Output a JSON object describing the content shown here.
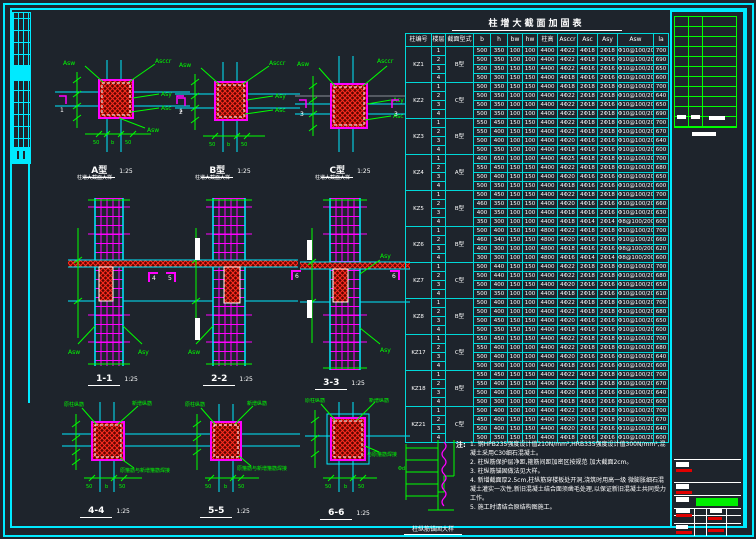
{
  "colors": {
    "frame": "#00eaff",
    "dims": "#00ff00",
    "rebar": "#ff00ff",
    "hatch": "#ff2d20",
    "text": "#ffffff"
  },
  "table": {
    "title": "柱增大截面加固表",
    "headers": [
      "柱编号",
      "楼层",
      "截面型式",
      "b",
      "h",
      "bw",
      "hw",
      "柱高",
      "Asccr",
      "Asc",
      "Asy",
      "Asw",
      "la"
    ],
    "groups": [
      {
        "id": "KZ1",
        "type": "B型",
        "rows": [
          [
            "1",
            "500",
            "350",
            "100",
            "100",
            "4400",
            "4Φ22",
            "4Φ18",
            "2Φ18",
            "Φ10@100/200",
            "700"
          ],
          [
            "2",
            "500",
            "350",
            "100",
            "100",
            "4400",
            "4Φ22",
            "4Φ18",
            "2Φ16",
            "Φ10@100/200",
            "690"
          ],
          [
            "3",
            "500",
            "350",
            "150",
            "150",
            "4400",
            "4Φ22",
            "4Φ16",
            "2Φ16",
            "Φ10@100/200",
            "650"
          ],
          [
            "4",
            "500",
            "300",
            "150",
            "150",
            "4400",
            "4Φ18",
            "4Φ16",
            "2Φ16",
            "Φ10@100/200",
            "600"
          ]
        ]
      },
      {
        "id": "KZ2",
        "type": "C型",
        "rows": [
          [
            "1",
            "500",
            "350",
            "150",
            "150",
            "4400",
            "4Φ18",
            "2Φ18",
            "2Φ18",
            "Φ10@100/200",
            "700"
          ],
          [
            "2",
            "500",
            "350",
            "100",
            "100",
            "4400",
            "4Φ22",
            "2Φ18",
            "2Φ18",
            "Φ10@100/200",
            "640"
          ],
          [
            "3",
            "500",
            "350",
            "100",
            "100",
            "4400",
            "4Φ22",
            "2Φ18",
            "2Φ16",
            "Φ10@100/200",
            "650"
          ],
          [
            "4",
            "500",
            "350",
            "100",
            "100",
            "4400",
            "4Φ22",
            "2Φ18",
            "2Φ18",
            "Φ10@100/200",
            "690"
          ]
        ]
      },
      {
        "id": "KZ3",
        "type": "B型",
        "rows": [
          [
            "1",
            "550",
            "450",
            "150",
            "150",
            "4400",
            "4Φ22",
            "4Φ18",
            "2Φ18",
            "Φ10@100/200",
            "700"
          ],
          [
            "2",
            "550",
            "400",
            "150",
            "150",
            "4400",
            "4Φ22",
            "4Φ18",
            "2Φ18",
            "Φ10@100/200",
            "670"
          ],
          [
            "3",
            "500",
            "400",
            "100",
            "100",
            "4400",
            "4Φ20",
            "4Φ16",
            "2Φ16",
            "Φ10@100/200",
            "640"
          ],
          [
            "4",
            "500",
            "350",
            "100",
            "100",
            "4400",
            "4Φ18",
            "4Φ16",
            "2Φ16",
            "Φ10@100/200",
            "600"
          ]
        ]
      },
      {
        "id": "KZ4",
        "type": "A型",
        "rows": [
          [
            "1",
            "400",
            "650",
            "100",
            "100",
            "4400",
            "4Φ25",
            "4Φ18",
            "2Φ18",
            "Φ10@100/200",
            "700"
          ],
          [
            "2",
            "550",
            "450",
            "150",
            "150",
            "4400",
            "4Φ22",
            "4Φ18",
            "2Φ18",
            "Φ10@100/200",
            "680"
          ],
          [
            "3",
            "500",
            "400",
            "150",
            "150",
            "4400",
            "4Φ20",
            "4Φ16",
            "2Φ16",
            "Φ10@100/200",
            "650"
          ],
          [
            "4",
            "500",
            "350",
            "150",
            "150",
            "4400",
            "4Φ18",
            "4Φ16",
            "2Φ16",
            "Φ10@100/200",
            "600"
          ]
        ]
      },
      {
        "id": "KZ5",
        "type": "B型",
        "rows": [
          [
            "1",
            "500",
            "450",
            "150",
            "150",
            "4400",
            "4Φ22",
            "4Φ18",
            "2Φ18",
            "Φ10@100/200",
            "700"
          ],
          [
            "2",
            "460",
            "350",
            "150",
            "150",
            "4400",
            "4Φ20",
            "4Φ16",
            "2Φ16",
            "Φ10@100/200",
            "660"
          ],
          [
            "3",
            "400",
            "350",
            "100",
            "100",
            "4400",
            "4Φ18",
            "4Φ16",
            "2Φ16",
            "Φ10@100/200",
            "630"
          ],
          [
            "4",
            "350",
            "300",
            "100",
            "100",
            "4400",
            "4Φ18",
            "4Φ14",
            "2Φ14",
            "Φ8@100/200",
            "600"
          ]
        ]
      },
      {
        "id": "KZ6",
        "type": "B型",
        "rows": [
          [
            "1",
            "500",
            "400",
            "150",
            "150",
            "4800",
            "4Φ22",
            "4Φ18",
            "2Φ18",
            "Φ10@100/200",
            "700"
          ],
          [
            "2",
            "460",
            "340",
            "150",
            "150",
            "4800",
            "4Φ20",
            "4Φ16",
            "2Φ16",
            "Φ10@100/200",
            "660"
          ],
          [
            "3",
            "400",
            "300",
            "100",
            "100",
            "4800",
            "4Φ18",
            "4Φ16",
            "2Φ16",
            "Φ8@100/200",
            "620"
          ],
          [
            "4",
            "300",
            "300",
            "100",
            "100",
            "4800",
            "4Φ16",
            "4Φ14",
            "2Φ14",
            "Φ8@100/200",
            "600"
          ]
        ]
      },
      {
        "id": "KZ7",
        "type": "C型",
        "rows": [
          [
            "1",
            "500",
            "440",
            "150",
            "150",
            "4400",
            "4Φ22",
            "2Φ18",
            "2Φ18",
            "Φ10@100/200",
            "700"
          ],
          [
            "2",
            "500",
            "440",
            "150",
            "150",
            "4400",
            "4Φ22",
            "2Φ18",
            "2Φ18",
            "Φ10@100/200",
            "680"
          ],
          [
            "3",
            "500",
            "400",
            "150",
            "150",
            "4400",
            "4Φ20",
            "2Φ16",
            "2Φ16",
            "Φ10@100/200",
            "650"
          ],
          [
            "4",
            "500",
            "350",
            "100",
            "100",
            "4400",
            "4Φ18",
            "2Φ16",
            "2Φ16",
            "Φ10@100/200",
            "610"
          ]
        ]
      },
      {
        "id": "KZ8",
        "type": "B型",
        "rows": [
          [
            "1",
            "500",
            "400",
            "100",
            "100",
            "4400",
            "4Φ22",
            "4Φ18",
            "2Φ18",
            "Φ10@100/200",
            "700"
          ],
          [
            "2",
            "500",
            "400",
            "100",
            "100",
            "4400",
            "4Φ22",
            "4Φ18",
            "2Φ18",
            "Φ10@100/200",
            "680"
          ],
          [
            "3",
            "500",
            "450",
            "150",
            "150",
            "4400",
            "4Φ20",
            "4Φ16",
            "2Φ16",
            "Φ10@100/200",
            "650"
          ],
          [
            "4",
            "500",
            "350",
            "150",
            "150",
            "4400",
            "4Φ18",
            "4Φ16",
            "2Φ16",
            "Φ10@100/200",
            "600"
          ]
        ]
      },
      {
        "id": "KZ17",
        "type": "C型",
        "rows": [
          [
            "1",
            "550",
            "450",
            "150",
            "150",
            "4400",
            "4Φ22",
            "2Φ18",
            "2Φ18",
            "Φ10@100/200",
            "700"
          ],
          [
            "2",
            "550",
            "400",
            "100",
            "100",
            "4400",
            "4Φ22",
            "2Φ18",
            "2Φ18",
            "Φ10@100/200",
            "680"
          ],
          [
            "3",
            "500",
            "400",
            "100",
            "100",
            "4400",
            "4Φ20",
            "2Φ16",
            "2Φ16",
            "Φ10@100/200",
            "640"
          ],
          [
            "4",
            "500",
            "300",
            "100",
            "100",
            "4400",
            "4Φ18",
            "2Φ16",
            "2Φ16",
            "Φ10@100/200",
            "600"
          ]
        ]
      },
      {
        "id": "KZ18",
        "type": "B型",
        "rows": [
          [
            "1",
            "550",
            "450",
            "150",
            "150",
            "4400",
            "4Φ22",
            "4Φ18",
            "2Φ18",
            "Φ10@100/200",
            "700"
          ],
          [
            "2",
            "550",
            "400",
            "150",
            "150",
            "4400",
            "4Φ22",
            "4Φ18",
            "2Φ18",
            "Φ10@100/200",
            "670"
          ],
          [
            "3",
            "500",
            "400",
            "100",
            "100",
            "4400",
            "4Φ20",
            "4Φ16",
            "2Φ16",
            "Φ10@100/200",
            "640"
          ],
          [
            "4",
            "500",
            "300",
            "100",
            "100",
            "4400",
            "4Φ18",
            "4Φ16",
            "2Φ16",
            "Φ10@100/200",
            "600"
          ]
        ]
      },
      {
        "id": "KZ21",
        "type": "C型",
        "rows": [
          [
            "1",
            "500",
            "400",
            "100",
            "100",
            "4400",
            "4Φ22",
            "2Φ18",
            "2Φ18",
            "Φ10@100/200",
            "700"
          ],
          [
            "2",
            "450",
            "400",
            "150",
            "150",
            "4400",
            "4Φ20",
            "2Φ18",
            "2Φ18",
            "Φ10@100/200",
            "670"
          ],
          [
            "3",
            "500",
            "400",
            "150",
            "150",
            "4400",
            "4Φ20",
            "2Φ16",
            "2Φ16",
            "Φ10@100/200",
            "640"
          ],
          [
            "4",
            "500",
            "350",
            "150",
            "150",
            "4400",
            "4Φ18",
            "2Φ16",
            "2Φ16",
            "Φ10@100/200",
            "600"
          ]
        ]
      }
    ]
  },
  "figures": {
    "plan_labels": {
      "asw": "Asw",
      "asccr": "Asccr",
      "asy": "Asy",
      "asc": "Asc",
      "b": "b",
      "fifty": "50"
    },
    "row1": [
      {
        "title": "A型",
        "scale": "1:25",
        "subtitle": "柱增大截面大样",
        "callout": "1"
      },
      {
        "title": "B型",
        "scale": "1:25",
        "subtitle": "柱增大截面大样",
        "callout": "2"
      },
      {
        "title": "C型",
        "scale": "1:25",
        "subtitle": "柱增大截面大样",
        "callout": "3"
      }
    ],
    "row2": [
      {
        "title": "1-1",
        "scale": "1:25"
      },
      {
        "title": "2-2",
        "scale": "1:25"
      },
      {
        "title": "3-3",
        "scale": "1:25"
      }
    ],
    "row2_callouts": [
      "4",
      "5",
      "6",
      "6"
    ],
    "row3": [
      {
        "title": "4-4",
        "scale": "1:25",
        "note": "原箍筋与新增箍筋焊接",
        "top_left": "原柱纵筋",
        "top_right": "新增纵筋"
      },
      {
        "title": "5-5",
        "scale": "1:25",
        "note": "原箍筋与新增箍筋焊接",
        "top_left": "原柱纵筋",
        "top_right": "新增纵筋"
      },
      {
        "title": "6-6",
        "scale": "1:25",
        "note": "与原箍筋焊接",
        "top_left": "原柱纵筋",
        "top_right": "新增纵筋"
      }
    ]
  },
  "detail": {
    "label": "Φd",
    "title": "柱纵筋锚固大样"
  },
  "notes": {
    "heading": "注:",
    "items": [
      "钢HPB235强度设计值210N/mm²,HRB335强度设计值300N/mm²,混凝土采用C30细石混凝土。",
      "柱纵筋保护层净距,箍筋间距加密区按规范 加大截面2cm。",
      "柱纵筋锚固做法见大样。",
      "新增截面厚2.5cm,柱纵筋穿楼板处开洞,浇筑时用高一级 微膨胀细石混凝土灌实一次性,新旧混凝土结合面须凿毛处理,以保证新旧混凝土共同受力工作。",
      "施工时请结合原结构图施工。"
    ]
  }
}
